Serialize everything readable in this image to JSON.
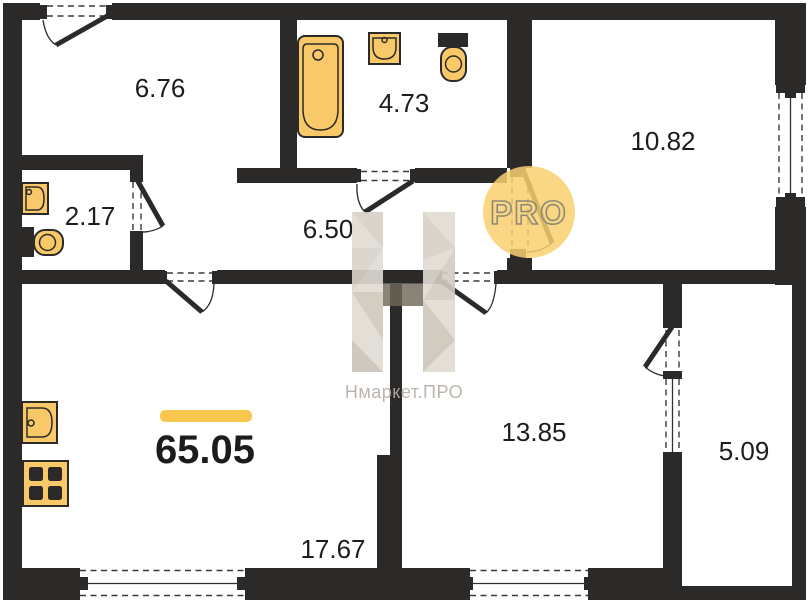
{
  "plan": {
    "total_area": "65.05",
    "rooms": [
      {
        "id": "entrance-hall",
        "area": "6.76"
      },
      {
        "id": "bathroom",
        "area": "4.73"
      },
      {
        "id": "wc",
        "area": "2.17"
      },
      {
        "id": "corridor",
        "area": "6.50"
      },
      {
        "id": "bedroom",
        "area": "10.82"
      },
      {
        "id": "living-room",
        "area": "13.85"
      },
      {
        "id": "kitchen-living",
        "area": "17.67"
      },
      {
        "id": "balcony",
        "area": "5.09"
      }
    ],
    "watermark": {
      "brand_text": "Нмаркет.ПРО",
      "badge_text": "PRO"
    },
    "colors": {
      "wall": "#2b2a28",
      "fixture_fill": "#f9c869",
      "accent_bar": "#f9c750",
      "badge_circle": "#f8d06e",
      "watermark_text": "#b5aea5"
    }
  }
}
